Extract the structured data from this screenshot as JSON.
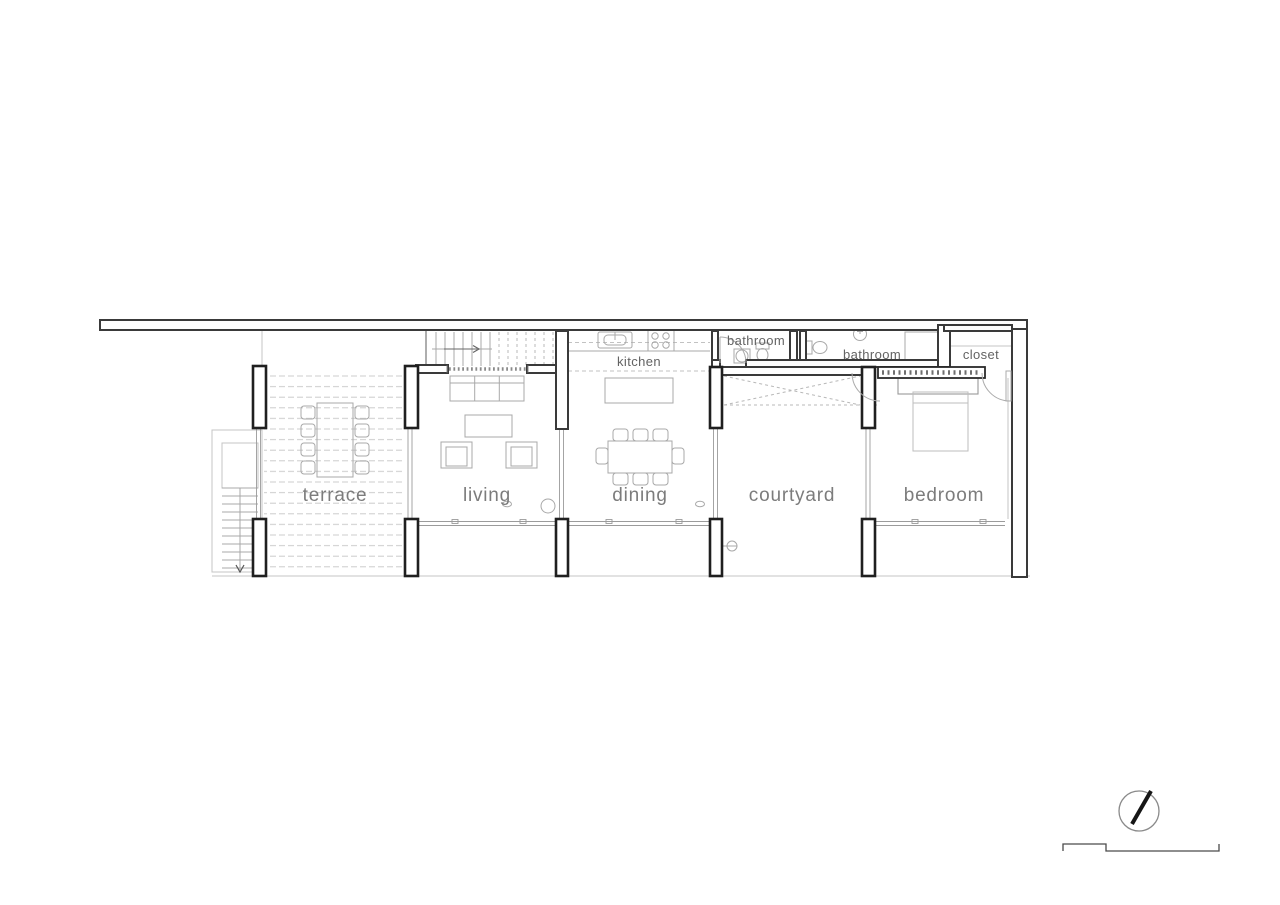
{
  "labels": {
    "terrace": "terrace",
    "living": "living",
    "dining": "dining",
    "courtyard": "courtyard",
    "bedroom": "bedroom",
    "kitchen": "kitchen",
    "bathroom_1": "bathroom",
    "bathroom_2": "bathroom",
    "closet": "closet"
  },
  "icons": {
    "north_arrow": "north-arrow-compass",
    "scale_bar": "graphic-scale-bar",
    "stair_up_arrow": "arrow-right",
    "stair_down_arrow": "arrow-down"
  },
  "colors": {
    "background": "#ffffff",
    "wall": "#3a3a3a",
    "pier": "#1f1f1f",
    "furniture_line": "#a8a8a8",
    "deck_dash": "#cccccc",
    "room_label": "#7c7c7c",
    "small_label": "#636363"
  }
}
